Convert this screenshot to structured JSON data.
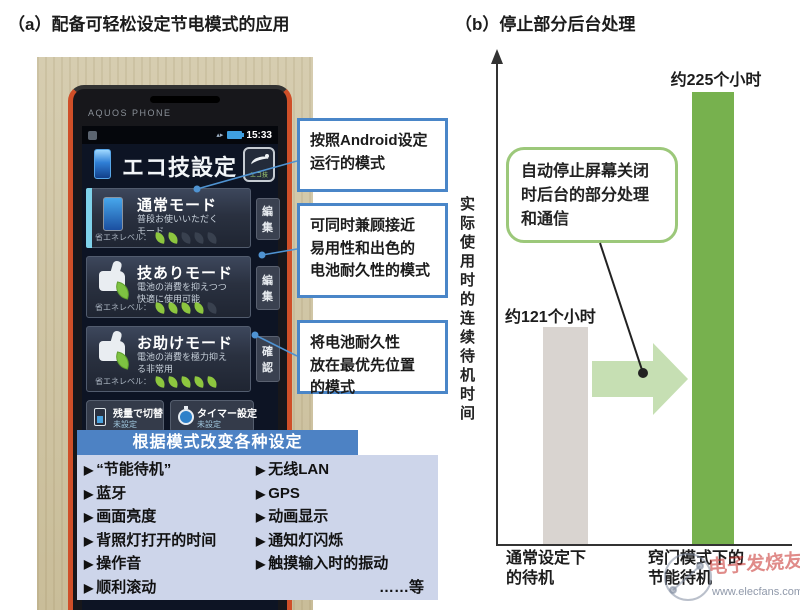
{
  "panel_a": {
    "title": "（a）配备可轻松设定节电模式的应用",
    "phone": {
      "brand": "AQUOS PHONE",
      "status_time": "15:33",
      "app_title": "エコ技設定",
      "badge_label": "エコ技",
      "modes": [
        {
          "name": "通常モード",
          "desc": "普段お使いいただく\nモード",
          "level_label": "省エネレベル：",
          "leaves_on": 2,
          "leaves_total": 5,
          "button": "編集"
        },
        {
          "name": "技ありモード",
          "desc": "電池の消費を抑えつつ\n快適に使用可能",
          "level_label": "省エネレベル：",
          "leaves_on": 4,
          "leaves_total": 5,
          "button": "編集"
        },
        {
          "name": "お助けモード",
          "desc": "電池の消費を極力抑え\nる非常用",
          "level_label": "省エネレベル：",
          "leaves_on": 5,
          "leaves_total": 5,
          "button": "確認"
        }
      ],
      "bottom_buttons": [
        {
          "label": "残量で切替",
          "sub": "未設定"
        },
        {
          "label": "タイマー設定",
          "sub": "未設定"
        }
      ]
    },
    "callouts": [
      "按照Android设定\n运行的模式",
      "可同时兼顾接近\n易用性和出色的\n电池耐久性的模式",
      "将电池耐久性\n放在最优先位置\n的模式"
    ],
    "overlay": {
      "header": "根据模式改变各种设定",
      "marker": "▶",
      "left_items": [
        "“节能待机”",
        "蓝牙",
        "画面亮度",
        "背照灯打开的时间",
        "操作音",
        "顺利滚动"
      ],
      "right_items": [
        "无线LAN",
        "GPS",
        "动画显示",
        "通知灯闪烁",
        "触摸输入时的振动"
      ],
      "etc_label": "……等"
    }
  },
  "panel_b": {
    "title": "（b）停止部分后台处理",
    "ylabel": "实际使用时的连续待机时间",
    "bubble": "自动停止屏幕关闭\n时后台的部分处理\n和通信",
    "bars": [
      {
        "value_label": "约121个小时",
        "category": "通常设定下\n的待机"
      },
      {
        "value_label": "约225个小时",
        "category": "窍门模式下的\n节能待机"
      }
    ],
    "watermark": {
      "brand": "电子发烧友",
      "url": "www.elecfans.com"
    }
  },
  "chart_data": {
    "type": "bar",
    "categories": [
      "通常设定下的待机",
      "窍门模式下的节能待机"
    ],
    "values": [
      121,
      225
    ],
    "unit": "小时",
    "value_labels": [
      "约121个小时",
      "约225个小时"
    ],
    "title": "（b）停止部分后台处理",
    "xlabel": "",
    "ylabel": "实际使用时的连续待机时间",
    "ylim": [
      0,
      240
    ],
    "grid": false,
    "bar_colors": [
      "#d9d4d0",
      "#77b14e"
    ],
    "annotation": "自动停止屏幕关闭时后台的部分处理和通信"
  },
  "colors": {
    "callout_border": "#4a86c8",
    "overlay_header_bg": "#4d82c4",
    "overlay_body_bg": "#cdd5ea",
    "bar_gray": "#d9d4d0",
    "bar_green": "#77b14e",
    "arrow_green": "#c6dfb3",
    "bubble_border": "#9cc87a",
    "leaf_green": "#8dc63f",
    "phone_frame_orange": "#cf4f28"
  }
}
